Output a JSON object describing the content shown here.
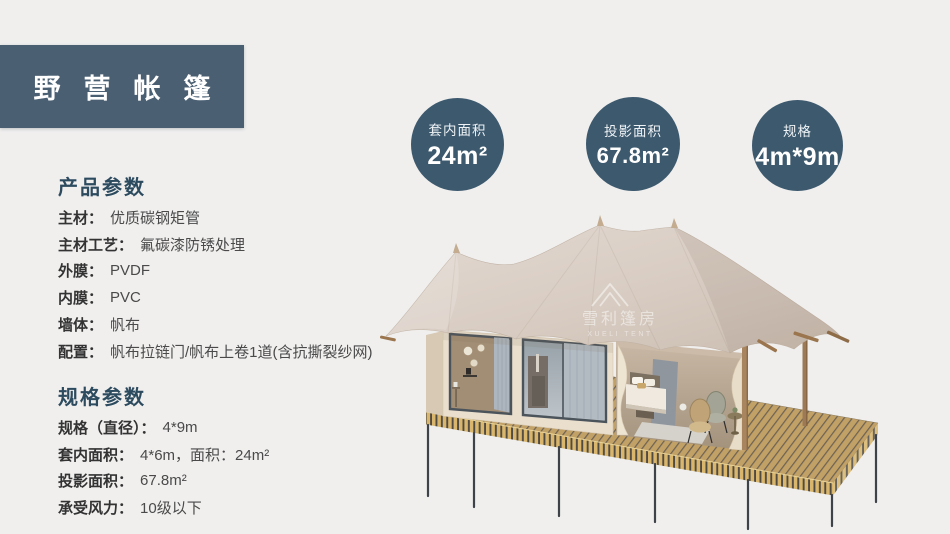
{
  "page": {
    "background": "#f0efee"
  },
  "header": {
    "title": "野营帐篷"
  },
  "badges": [
    {
      "label": "套内面积",
      "value": "24m²"
    },
    {
      "label": "投影面积",
      "value": "67.8m²"
    },
    {
      "label": "规格",
      "value": "4m*9m"
    }
  ],
  "sections": {
    "product": {
      "heading": "产品参数",
      "items": [
        {
          "label": "主材：",
          "value": "优质碳钢矩管"
        },
        {
          "label": "主材工艺：",
          "value": "氟碳漆防锈处理"
        },
        {
          "label": "外膜：",
          "value": "PVDF"
        },
        {
          "label": "内膜：",
          "value": "PVC"
        },
        {
          "label": "墙体：",
          "value": "帆布"
        },
        {
          "label": "配置：",
          "value": "帆布拉链门/帆布上卷1道(含抗撕裂纱网)"
        }
      ]
    },
    "spec": {
      "heading": "规格参数",
      "items": [
        {
          "label": "规格（直径）：",
          "value": "4*9m"
        },
        {
          "label": "套内面积：",
          "value": "4*6m，面积：24m²"
        },
        {
          "label": "投影面积：",
          "value": "67.8m²"
        },
        {
          "label": "承受风力：",
          "value": "10级以下"
        }
      ]
    }
  },
  "tent": {
    "watermark_cn": "雪利篷房",
    "watermark_en": "XUELI TENT"
  },
  "colors": {
    "header_bg": "#4a5f72",
    "badge_bg": "#3d596e",
    "heading_text": "#2d4b5f",
    "roof_tan": "#d8ccc2",
    "deck_wood": "#c2a167"
  }
}
